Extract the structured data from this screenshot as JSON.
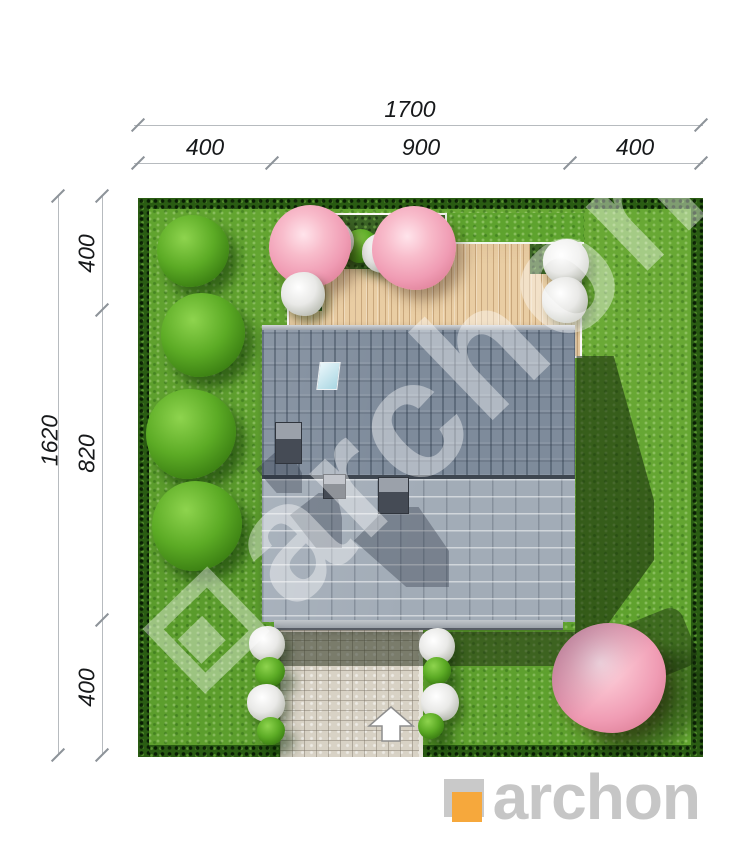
{
  "drawing": {
    "top_dimensions": {
      "total": "1700",
      "segments": [
        "400",
        "900",
        "400"
      ]
    },
    "left_dimensions": {
      "total": "1620",
      "segments": [
        "400",
        "820",
        "400"
      ]
    }
  },
  "watermark": {
    "text": "archon"
  },
  "footer": {
    "brand": "archon"
  },
  "colors": {
    "brand_orange": "#F6A83C",
    "logo_gray": "#C6C6C6",
    "grass_green": "#61A42F",
    "hedge_green": "#2A5C13",
    "roof_upper_gray": "#7E8B9B",
    "roof_lower_gray": "#A2ACB7",
    "deck_wood": "#E9CDA3",
    "pink_tree": "#F09CB4"
  },
  "icons": {
    "entrance_arrow": "up-arrow",
    "watermark_logo": "archon-square-mark",
    "footer_logo": "archon-square-mark"
  }
}
